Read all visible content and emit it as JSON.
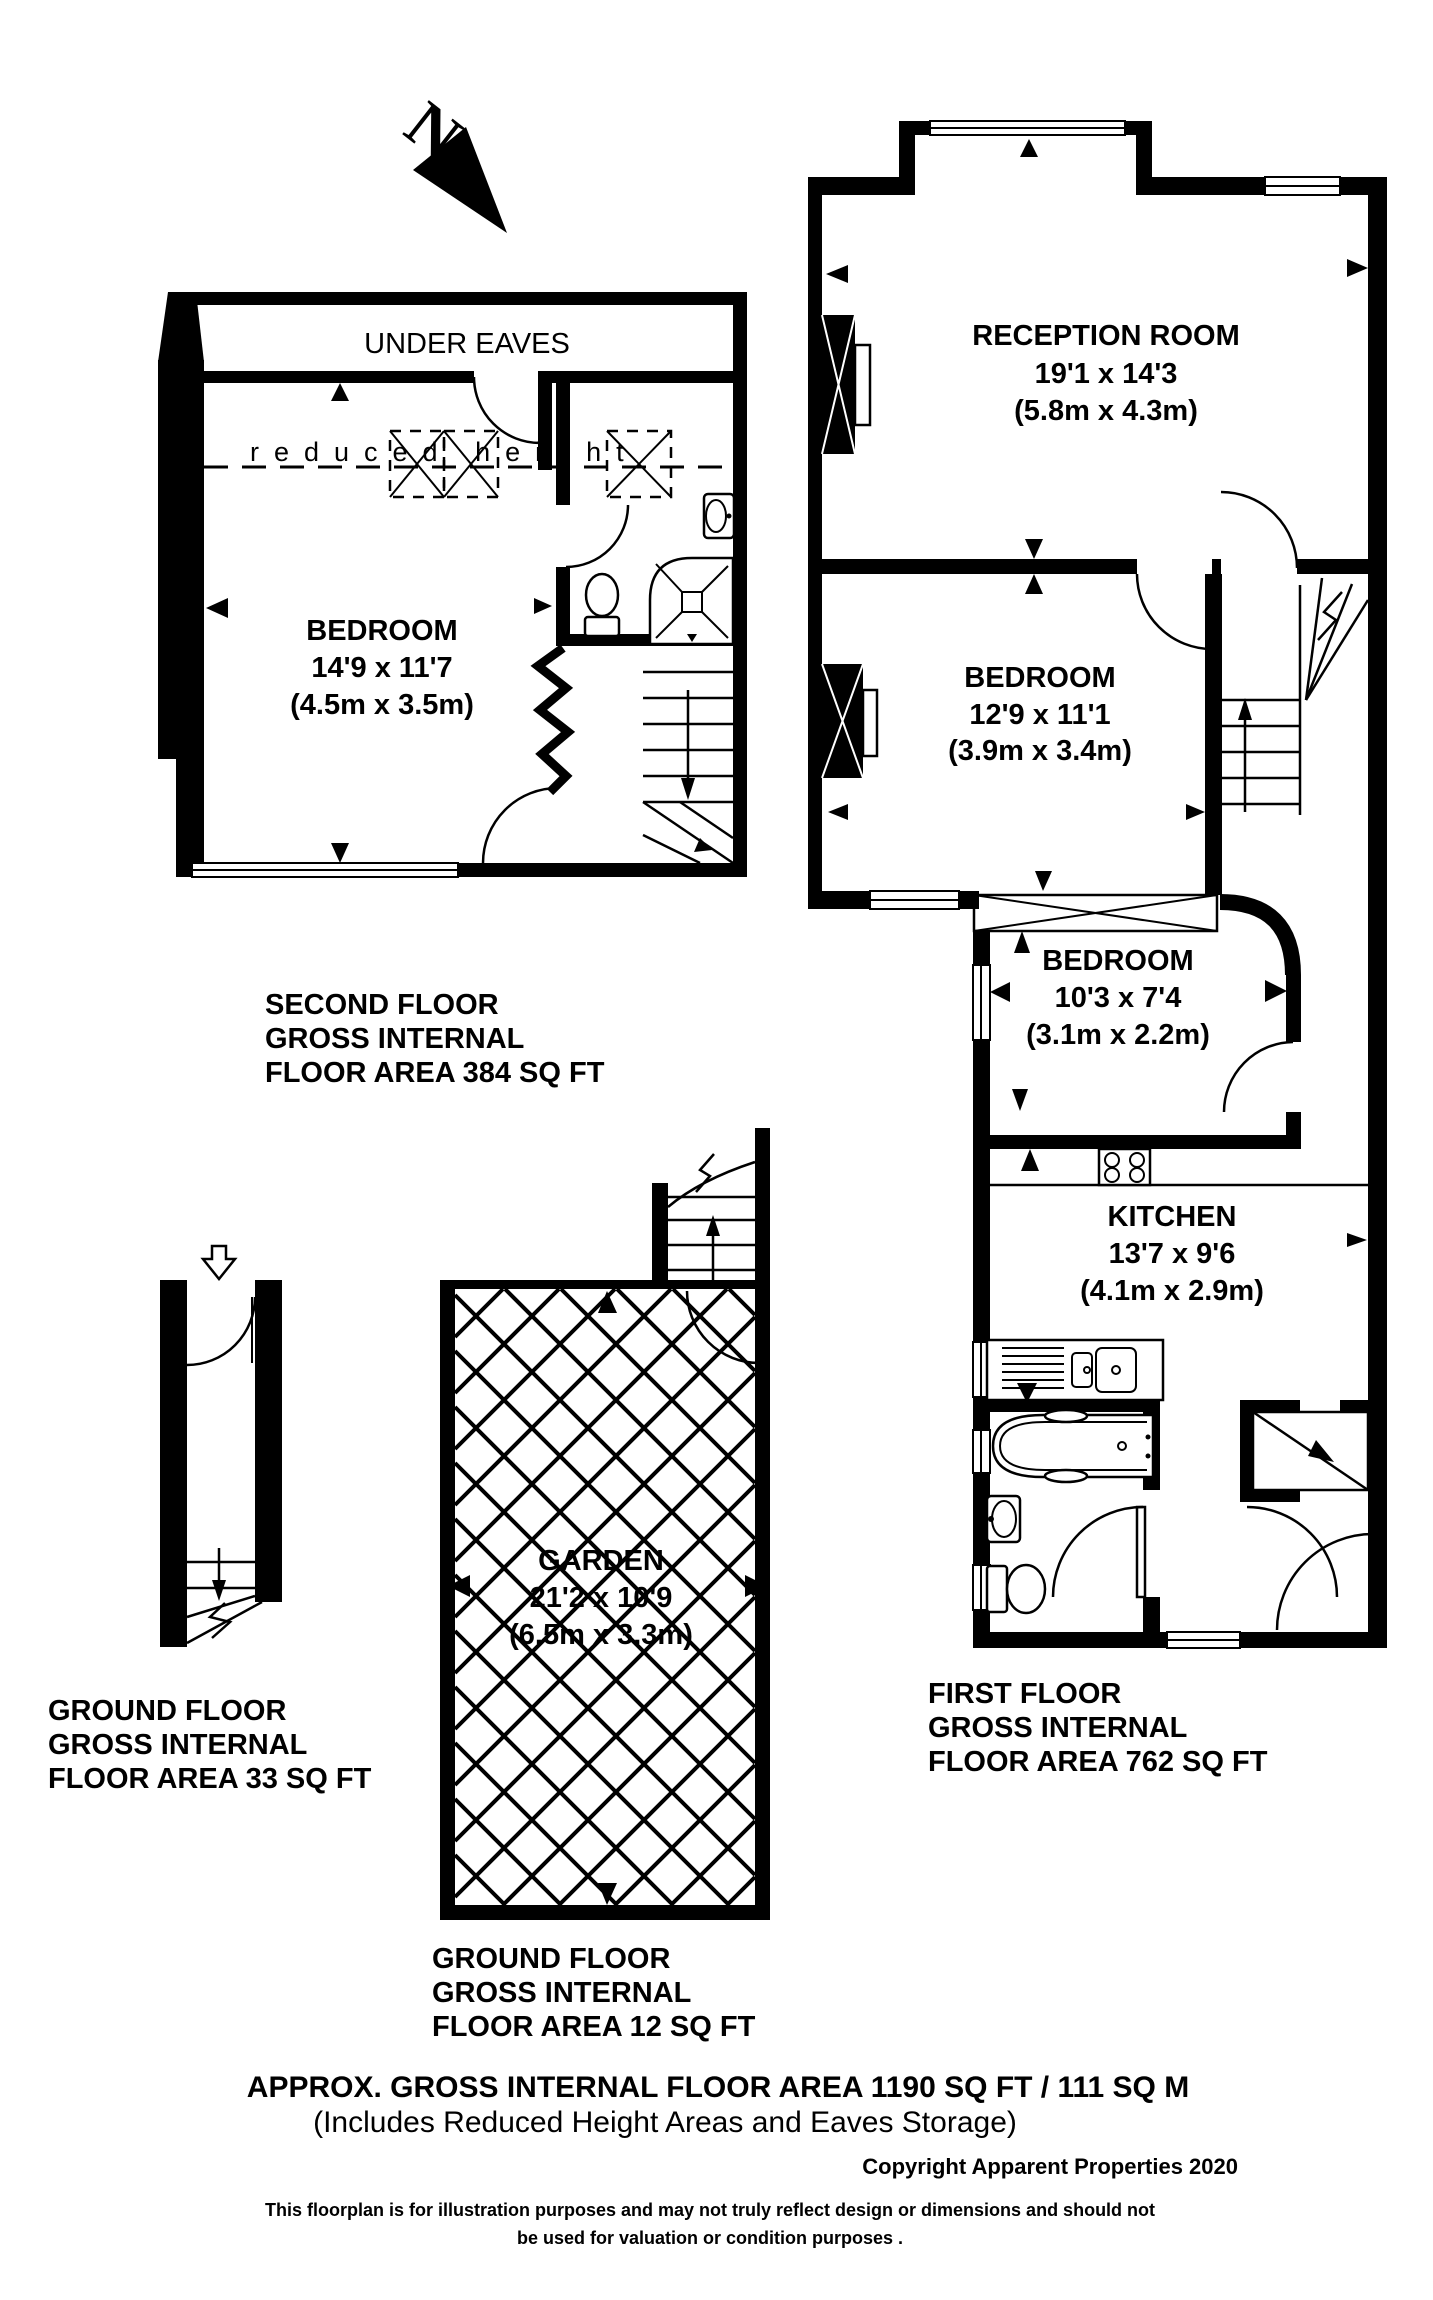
{
  "meta": {
    "background": "#ffffff",
    "ink": "#000000"
  },
  "north": {
    "label": "N"
  },
  "second_floor": {
    "under_eaves": "UNDER EAVES",
    "reduced_height": "reduced height",
    "room": {
      "name": "BEDROOM",
      "imperial": "14'9 x 11'7",
      "metric": "(4.5m x 3.5m)"
    },
    "caption": [
      "SECOND FLOOR",
      "GROSS INTERNAL",
      "FLOOR AREA 384 SQ FT"
    ]
  },
  "first_floor": {
    "reception": {
      "name": "RECEPTION ROOM",
      "imperial": "19'1 x 14'3",
      "metric": "(5.8m x 4.3m)"
    },
    "bedroom_large": {
      "name": "BEDROOM",
      "imperial": "12'9 x 11'1",
      "metric": "(3.9m x 3.4m)"
    },
    "bedroom_small": {
      "name": "BEDROOM",
      "imperial": "10'3 x 7'4",
      "metric": "(3.1m x 2.2m)"
    },
    "kitchen": {
      "name": "KITCHEN",
      "imperial": "13'7 x 9'6",
      "metric": "(4.1m x 2.9m)"
    },
    "caption": [
      "FIRST FLOOR",
      "GROSS INTERNAL",
      "FLOOR AREA 762 SQ FT"
    ]
  },
  "ground_floor_hall": {
    "caption": [
      "GROUND FLOOR",
      "GROSS INTERNAL",
      "FLOOR AREA 33 SQ FT"
    ]
  },
  "garden": {
    "room": {
      "name": "GARDEN",
      "imperial": "21'2 x 10'9",
      "metric": "(6.5m x 3.3m)"
    },
    "caption": [
      "GROUND FLOOR",
      "GROSS INTERNAL",
      "FLOOR AREA 12 SQ FT"
    ]
  },
  "footer": {
    "area_total": "APPROX. GROSS INTERNAL FLOOR AREA 1190 SQ FT / 111 SQ M",
    "area_note": "(Includes Reduced Height Areas and Eaves Storage)",
    "copyright": "Copyright Apparent Properties 2020",
    "disclaimer": [
      "This floorplan is for illustration purposes and may not truly reflect design or dimensions and should not",
      "be used for valuation or condition purposes ."
    ]
  }
}
